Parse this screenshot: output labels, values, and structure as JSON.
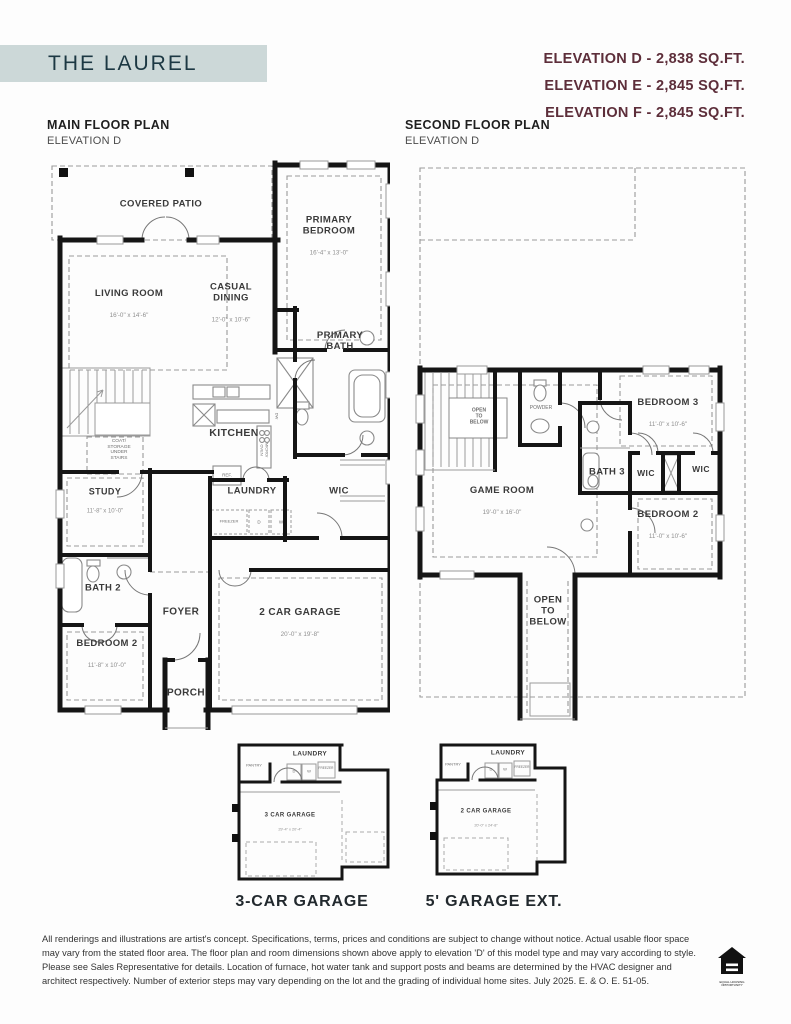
{
  "colors": {
    "header_bg": "#ccd8d8",
    "header_text": "#1c3843",
    "elevation_text": "#5d2e3a",
    "plan_line": "#151515"
  },
  "header": {
    "title": "THE LAUREL",
    "elevations": [
      "ELEVATION D - 2,838 SQ.FT.",
      "ELEVATION E - 2,845 SQ.FT.",
      "ELEVATION F - 2,845 SQ.FT."
    ]
  },
  "main_floor": {
    "title": "MAIN FLOOR PLAN",
    "subtitle": "ELEVATION D",
    "rooms": {
      "covered_patio": {
        "name": "COVERED PATIO"
      },
      "primary_bedroom": {
        "name": "PRIMARY\nBEDROOM",
        "dims": "16'-4\" x 13'-0\""
      },
      "living_room": {
        "name": "LIVING ROOM",
        "dims": "16'-0\" x 14'-6\""
      },
      "casual_dining": {
        "name": "CASUAL\nDINING",
        "dims": "12'-0\" x 10'-6\""
      },
      "primary_bath": {
        "name": "PRIMARY\nBATH"
      },
      "kitchen": {
        "name": "KITCHEN"
      },
      "coat_storage": {
        "name": "COAT/\nSTORAGE\nUNDER\nSTAIRS"
      },
      "study": {
        "name": "STUDY",
        "dims": "11'-8\" x 10'-0\""
      },
      "ref": {
        "name": "REF."
      },
      "laundry": {
        "name": "LAUNDRY"
      },
      "wic": {
        "name": "WIC"
      },
      "freezer": {
        "name": "FREEZER"
      },
      "dryer": {
        "name": "D"
      },
      "washer": {
        "name": "W"
      },
      "dw": {
        "name": "DW"
      },
      "micro_oven": {
        "name": "MICRO/\nOVEN"
      },
      "bath2": {
        "name": "BATH 2"
      },
      "foyer": {
        "name": "FOYER"
      },
      "garage": {
        "name": "2 CAR GARAGE",
        "dims": "20'-0\" x 19'-8\""
      },
      "bedroom2": {
        "name": "BEDROOM 2",
        "dims": "11'-8\" x 10'-0\""
      },
      "porch": {
        "name": "PORCH"
      }
    }
  },
  "second_floor": {
    "title": "SECOND FLOOR PLAN",
    "subtitle": "ELEVATION D",
    "rooms": {
      "open_to_below_stairs": {
        "name": "OPEN\nTO\nBELOW"
      },
      "powder": {
        "name": "POWDER"
      },
      "bedroom3": {
        "name": "BEDROOM 3",
        "dims": "11'-0\" x 10'-6\""
      },
      "game_room": {
        "name": "GAME ROOM",
        "dims": "19'-0\" x 16'-0\""
      },
      "bath3": {
        "name": "BATH 3"
      },
      "wic_left": {
        "name": "WIC"
      },
      "wic_right": {
        "name": "WIC"
      },
      "bedroom2": {
        "name": "BEDROOM 2",
        "dims": "11'-0\" x 10'-6\""
      },
      "open_to_below_hall": {
        "name": "OPEN\nTO\nBELOW"
      }
    }
  },
  "options": {
    "option1": {
      "caption": "3-CAR GARAGE",
      "rooms": {
        "pantry": {
          "name": "PANTRY"
        },
        "laundry": {
          "name": "LAUNDRY"
        },
        "freezer": {
          "name": "FREEZER"
        },
        "dryer": {
          "name": "D"
        },
        "washer": {
          "name": "W"
        },
        "garage": {
          "name": "3 CAR GARAGE",
          "dims": "29'-4\" x 20'-4\""
        }
      }
    },
    "option2": {
      "caption": "5' GARAGE EXT.",
      "rooms": {
        "pantry": {
          "name": "PANTRY"
        },
        "laundry": {
          "name": "LAUNDRY"
        },
        "freezer": {
          "name": "FREEZER"
        },
        "dryer": {
          "name": "D"
        },
        "washer": {
          "name": "W"
        },
        "garage": {
          "name": "2 CAR GARAGE",
          "dims": "20'-0\" x 24'-8\""
        }
      }
    }
  },
  "footer": {
    "disclaimer": "All renderings and illustrations are artist's concept. Specifications, terms, prices and conditions are subject to change without notice. Actual usable floor space may vary from the stated floor area. The floor plan and room dimensions shown above apply to elevation 'D' of this model type and may vary according to style. Please see Sales Representative for details. Location of furnace, hot water tank and support posts and beams are determined by the HVAC designer and architect respectively. Number of exterior steps may vary depending on the lot and the grading of individual home sites. July 2025. E. & O. E. 51-05.",
    "equal_housing_label": "EQUAL HOUSING\nOPPORTUNITY"
  }
}
